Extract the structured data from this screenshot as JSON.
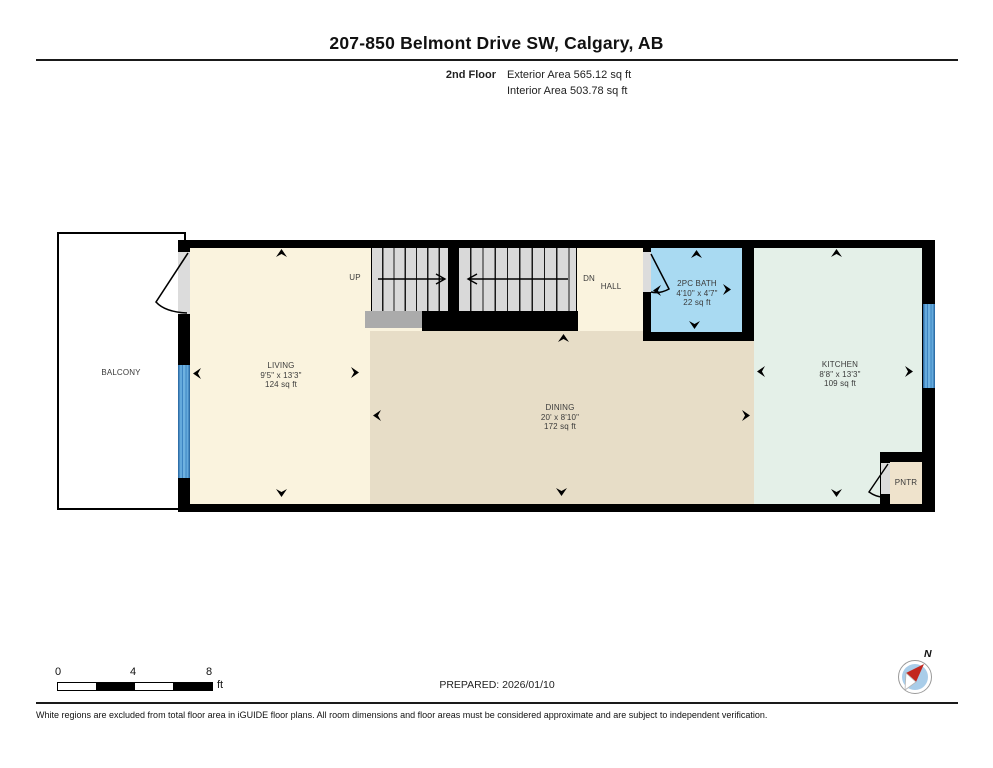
{
  "header": {
    "title": "207-850 Belmont Drive SW, Calgary, AB",
    "floor_label": "2nd Floor",
    "exterior_area": "Exterior Area 565.12 sq ft",
    "interior_area": "Interior Area 503.78 sq ft"
  },
  "rooms": {
    "balcony": {
      "name": "BALCONY"
    },
    "living": {
      "name": "LIVING",
      "dims": "9'5\" x 13'3\"",
      "area": "124 sq ft"
    },
    "dining": {
      "name": "DINING",
      "dims": "20' x 8'10\"",
      "area": "172 sq ft"
    },
    "hall": {
      "name": "HALL"
    },
    "bath": {
      "name": "2PC BATH",
      "dims": "4'10\" x 4'7\"",
      "area": "22 sq ft"
    },
    "kitchen": {
      "name": "KITCHEN",
      "dims": "8'8\" x 13'3\"",
      "area": "109 sq ft"
    },
    "pantry": {
      "name": "PNTR"
    }
  },
  "stairs": {
    "up_label": "UP",
    "down_label": "DN"
  },
  "footer": {
    "scale_ticks": [
      "0",
      "4",
      "8"
    ],
    "scale_unit": "ft",
    "prepared": "PREPARED: 2026/01/10",
    "compass_north": "N",
    "disclaimer": "White regions are excluded from total floor area in iGUIDE floor plans. All room dimensions and floor areas must be considered approximate and are subject to independent verification."
  },
  "colors": {
    "wall": "#000000",
    "living": "#FAF3DE",
    "dining": "#E7DDC7",
    "bath": "#A9DAF2",
    "kitchen": "#E4F0E8",
    "pantry": "#EFE3CC",
    "stairs": "#D9D9D9",
    "window_blue": "#4D94CC",
    "compass_needle": "#C2271E"
  }
}
